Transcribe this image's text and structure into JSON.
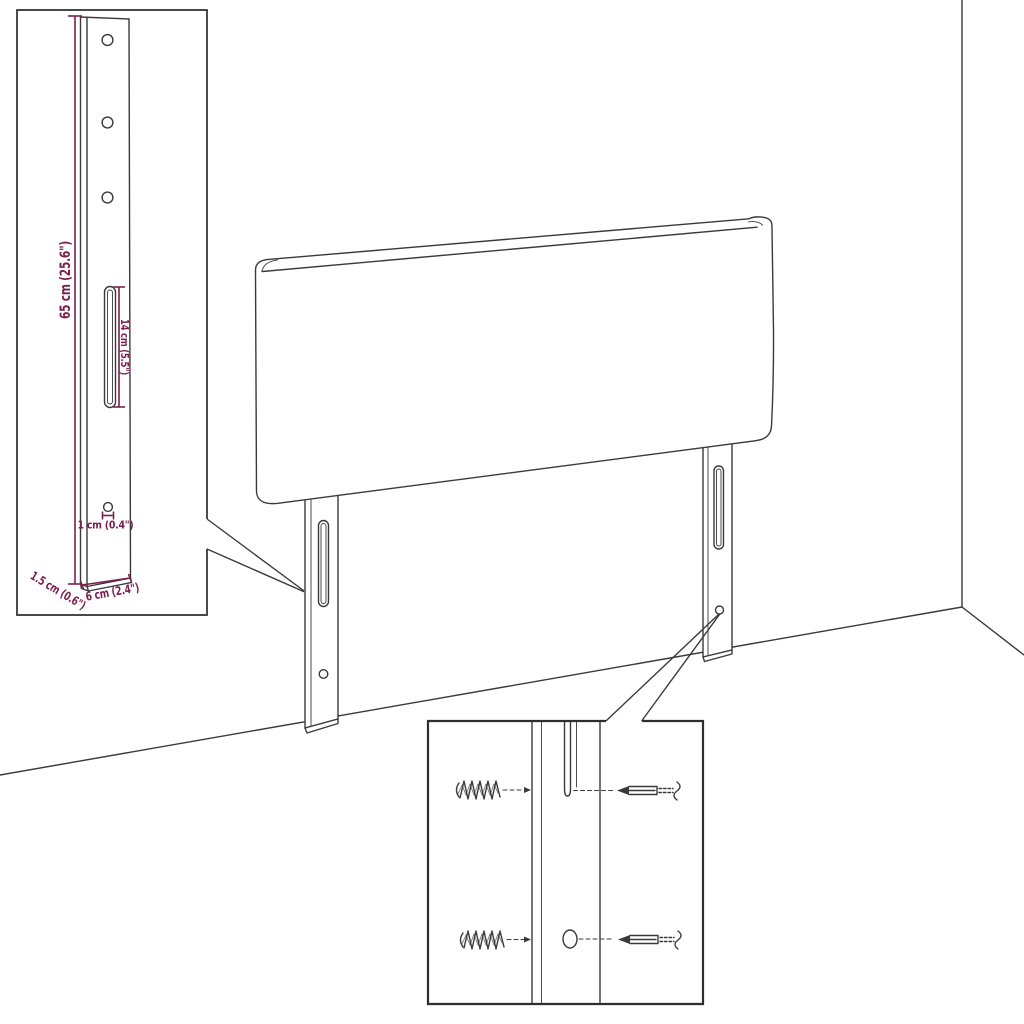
{
  "page": {
    "title": "Headboard assembly dimension diagram",
    "background": "#ffffff"
  },
  "colors": {
    "outline": "#3a3a3a",
    "inset_border": "#2e2e2e",
    "dimension": "#7a2050"
  },
  "bracket_inset": {
    "description": "side view of mounting leg with dimension callouts",
    "labels": {
      "height": "65 cm (25.6\")",
      "slot_length": "14 cm (5.5\")",
      "hole_diameter": "1 cm (0.4\")",
      "thickness": "1.5 cm (0.6\")",
      "width": "6 cm (2.4\")"
    }
  },
  "screw_inset": {
    "description": "front view of leg slot and hole with wall plugs and screws"
  }
}
